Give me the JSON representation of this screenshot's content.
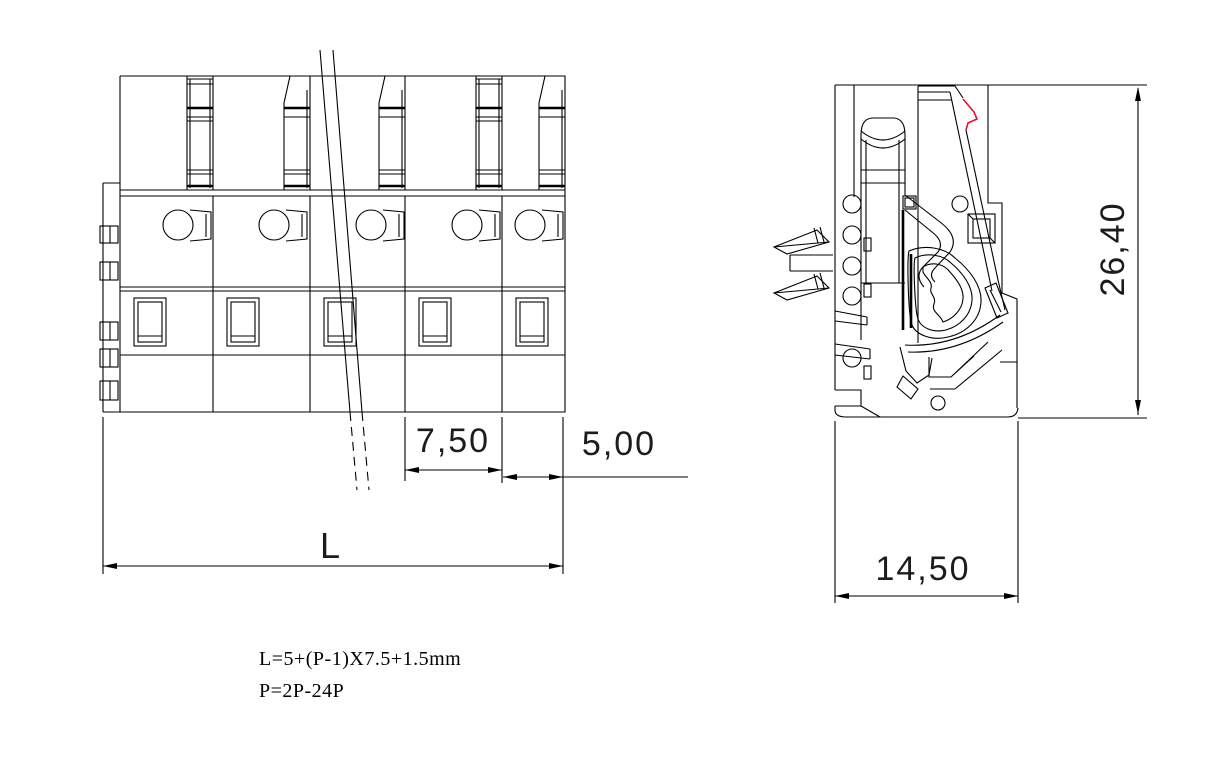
{
  "drawing": {
    "type": "technical-drawing",
    "subject": "pluggable spring terminal block connector",
    "views": {
      "front_view": {
        "name": "front-view",
        "poles_shown": 5,
        "dimensions": [
          {
            "id": "pitch",
            "label": "7,50"
          },
          {
            "id": "end_width",
            "label": "5,00"
          },
          {
            "id": "total_length",
            "label": "L"
          }
        ]
      },
      "side_view": {
        "name": "side-view",
        "dimensions": [
          {
            "id": "height",
            "label": "26,40"
          },
          {
            "id": "depth",
            "label": "14,50"
          }
        ]
      }
    },
    "notes": [
      "L=5+(P-1)X7.5+1.5mm",
      "P=2P-24P"
    ],
    "colors": {
      "line": "#000000",
      "background": "#ffffff",
      "accent_red": "#e8112d"
    }
  }
}
